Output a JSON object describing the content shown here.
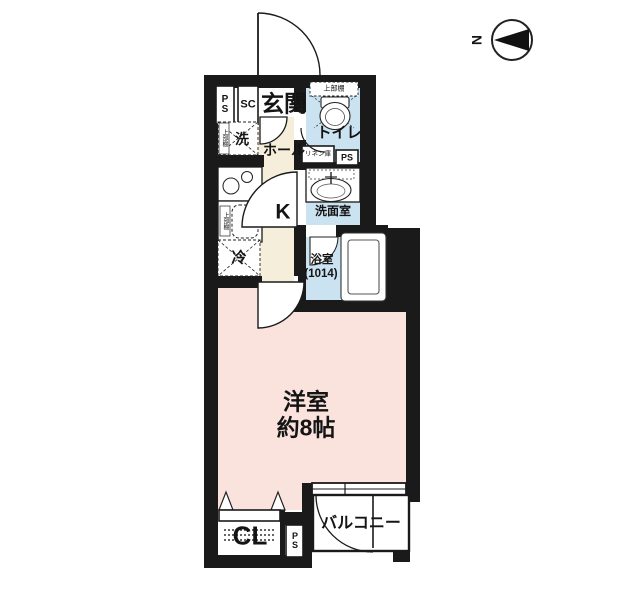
{
  "compass": {
    "north_label": "N"
  },
  "colors": {
    "wall": "#1a1a1a",
    "hall_floor": "#f5eedb",
    "wet_area_floor": "#cbe2f0",
    "main_room_floor": "#f9e3dc",
    "fixture_fill": "#ffffff"
  },
  "rooms": {
    "genkan": "玄関",
    "hall": "ホール",
    "kitchen": "K",
    "toilet": "トイレ",
    "washroom": "洗面室",
    "bathroom": "浴室",
    "bathroom_size": "(1014)",
    "main_room": "洋室",
    "main_room_size": "約8帖",
    "closet": "CL",
    "balcony": "バルコニー"
  },
  "fixtures": {
    "washer": "洗",
    "fridge": "冷",
    "shoe_closet": "SC",
    "upper_shelf_toilet": "上部棚",
    "upper_shelf_washer": "上部棚",
    "upper_shelf_sink": "上部棚",
    "linen_storage": "リネン庫",
    "pipe_space_top": "P\nS",
    "pipe_space_mid": "PS",
    "pipe_space_bottom": "P\nS"
  }
}
